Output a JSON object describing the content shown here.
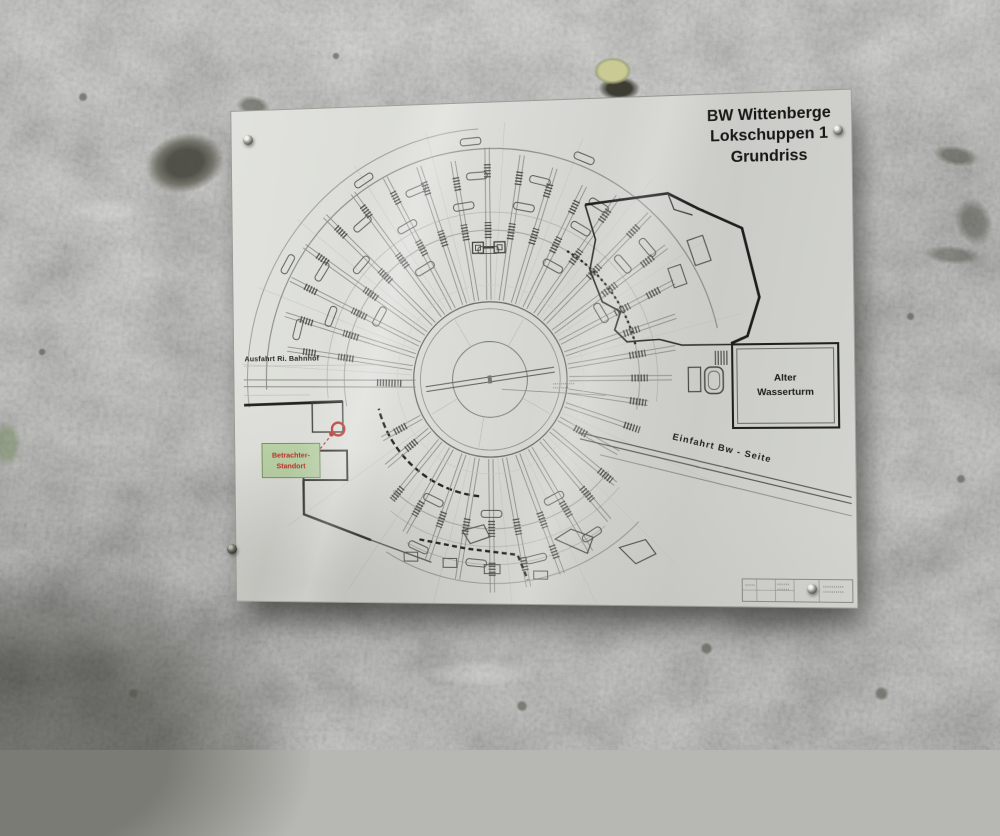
{
  "sign": {
    "title_lines": [
      "BW Wittenberge",
      "Lokschuppen 1",
      "Grundriss"
    ],
    "label_exit": "Ausfahrt Ri. Bahnhof",
    "label_water_tower_lines": [
      "Alter",
      "Wasserturm"
    ],
    "label_entry": "Einfahrt Bw - Seite",
    "viewer_label_lines": [
      "Betrachter-",
      "Standort"
    ],
    "colors": {
      "paper": "#d8d9d4",
      "wall": "#b7b8b3",
      "ink_dark": "#1d1d1b",
      "ink_mid": "#55554f",
      "ink_light": "#9a9a96",
      "marker_red": "#b5342a",
      "viewer_bg": "#b9d2a6",
      "viewer_border": "#75905e",
      "viewer_text": "#c22b20"
    }
  },
  "plan": {
    "center": [
      266,
      278
    ],
    "turntable": {
      "radii": [
        78,
        71,
        38
      ],
      "bridge_angle": -8,
      "spokes": [
        -120,
        -60,
        30,
        100,
        150
      ]
    },
    "colors": {
      "track": "#8d8d8a",
      "hatch": "#4c4c49",
      "guide": "#c0c0bc",
      "loco": "#5a5a57"
    },
    "guides": [
      -176,
      -158,
      -140,
      -122,
      -104,
      -86,
      -68,
      -50,
      -32,
      -14,
      25,
      45,
      65,
      85,
      105,
      125,
      145
    ],
    "tracks": [
      [
        -171,
        212
      ],
      [
        -162,
        222
      ],
      [
        -153,
        230
      ],
      [
        -144,
        235
      ],
      [
        -135,
        238
      ],
      [
        -126,
        236
      ],
      [
        -117,
        231
      ],
      [
        -108,
        227
      ],
      [
        -99,
        223
      ],
      [
        -90,
        233
      ],
      [
        -81,
        227
      ],
      [
        -72,
        221
      ],
      [
        -63,
        215
      ],
      [
        -54,
        223
      ],
      [
        -45,
        229
      ],
      [
        -36,
        220
      ],
      [
        -27,
        208
      ],
      [
        -18,
        196
      ],
      [
        -9,
        188
      ],
      [
        0,
        182
      ],
      [
        9,
        160
      ],
      [
        19,
        150
      ],
      [
        30,
        148
      ],
      [
        40,
        163
      ],
      [
        50,
        184
      ],
      [
        60,
        199
      ],
      [
        70,
        207
      ],
      [
        80,
        211
      ],
      [
        90,
        214
      ],
      [
        100,
        204
      ],
      [
        110,
        193
      ],
      [
        120,
        178
      ],
      [
        130,
        158
      ],
      [
        141,
        138
      ],
      [
        152,
        126
      ]
    ],
    "arcs": [
      [
        150,
        -190,
        12,
        1,
        "",
        "#a2a29e"
      ],
      [
        150,
        38,
        132,
        1,
        "",
        "#a2a29e"
      ],
      [
        168,
        -186,
        8,
        0.8,
        "",
        "#b2b2ae"
      ],
      [
        168,
        40,
        128,
        0.8,
        "",
        "#b5b5b1"
      ],
      [
        232,
        -182,
        -12,
        1.2,
        "",
        "#8e8e8a"
      ],
      [
        252,
        -186,
        -92,
        1,
        "",
        "#9c9c98"
      ],
      [
        205,
        44,
        122,
        1,
        "",
        "#9a9a94"
      ],
      [
        186,
        52,
        118,
        0.8,
        "",
        "#adada9"
      ],
      [
        118,
        96,
        166,
        2.4,
        "6 3.5",
        "#22221f"
      ],
      [
        150,
        -58,
        -12,
        2.2,
        "2.5 3",
        "#22221f"
      ]
    ],
    "locos": [
      [
        205,
        -165
      ],
      [
        205,
        -147
      ],
      [
        205,
        -129
      ],
      [
        205,
        -111
      ],
      [
        205,
        -93
      ],
      [
        205,
        -75
      ],
      [
        205,
        -57
      ],
      [
        205,
        -39
      ],
      [
        176,
        -158
      ],
      [
        176,
        -138
      ],
      [
        176,
        -118
      ],
      [
        176,
        -98
      ],
      [
        176,
        -78
      ],
      [
        176,
        -58
      ],
      [
        176,
        -40
      ],
      [
        240,
        -150
      ],
      [
        240,
        -122
      ],
      [
        240,
        -94
      ],
      [
        240,
        -66
      ],
      [
        130,
        -150
      ],
      [
        130,
        -120
      ],
      [
        130,
        -90
      ],
      [
        130,
        -60
      ],
      [
        130,
        -30
      ],
      [
        185,
        57
      ],
      [
        185,
        76
      ],
      [
        185,
        95
      ],
      [
        185,
        114
      ],
      [
        135,
        62
      ],
      [
        135,
        90
      ],
      [
        135,
        116
      ]
    ],
    "extras": [
      {
        "t": "path",
        "p": "M 364 105 L 446 96 L 476 112 L 518 132 L 534 200 L 522 238 L 506 245",
        "s": "#1d1d1b",
        "w": 2.6
      },
      {
        "t": "path",
        "p": "M 364 105 L 374 140 L 368 170 L 380 202 L 398 212 L 392 230 L 404 242 L 436 240 L 458 246 L 506 246",
        "s": "#2c2c29",
        "w": 1.6
      },
      {
        "t": "path",
        "p": "M 446 96 L 452 112 L 470 118",
        "s": "#3a3a36",
        "w": 1.2
      },
      {
        "t": "line",
        "x1": 10,
        "y1": 276,
        "x2": 190,
        "y2": 278,
        "s": "#8d8d8a",
        "w": 1
      },
      {
        "t": "line",
        "x1": 10,
        "y1": 283,
        "x2": 190,
        "y2": 285,
        "s": "#8d8d8a",
        "w": 1
      },
      {
        "t": "line",
        "x1": 150,
        "y1": 280,
        "x2": 176,
        "y2": 281,
        "s": "#4c4c49",
        "w": 7,
        "d": "1.3 1.7"
      },
      {
        "t": "line",
        "x1": 10,
        "y1": 262,
        "x2": 150,
        "y2": 262,
        "s": "#b0b0ab",
        "w": 0.6
      },
      {
        "t": "line",
        "x1": 10,
        "y1": 292,
        "x2": 80,
        "y2": 292,
        "s": "#b0b0ab",
        "w": 0.6
      },
      {
        "t": "line",
        "x1": 10,
        "y1": 302,
        "x2": 114,
        "y2": 299,
        "s": "#22221f",
        "w": 2.8
      },
      {
        "t": "rect",
        "x": 82,
        "y": 299,
        "wd": 32,
        "ht": 31,
        "s": "#3a3a37",
        "w": 1.4
      },
      {
        "t": "line",
        "x1": 490,
        "y1": 259,
        "x2": 504,
        "y2": 259,
        "s": "#56544f",
        "w": 14,
        "d": "1.2 1.6"
      },
      {
        "t": "rect",
        "x": 464,
        "y": 268,
        "wd": 12,
        "ht": 24,
        "s": "#4a4a47",
        "w": 1.2
      },
      {
        "t": "rect",
        "x": 480,
        "y": 268,
        "wd": 18,
        "ht": 26,
        "rx": 6,
        "s": "#4a4a47",
        "w": 1.4
      },
      {
        "t": "rect",
        "x": 483.5,
        "y": 272,
        "wd": 11,
        "ht": 18,
        "rx": 5,
        "s": "#6b6b68",
        "w": 0.9
      },
      {
        "t": "line",
        "x1": 356,
        "y1": 332,
        "x2": 620,
        "y2": 396,
        "s": "#55554f",
        "w": 1.1
      },
      {
        "t": "line",
        "x1": 356,
        "y1": 338,
        "x2": 620,
        "y2": 402,
        "s": "#55554f",
        "w": 1.1
      },
      {
        "t": "line",
        "x1": 376,
        "y1": 354,
        "x2": 620,
        "y2": 414,
        "s": "#8a8a85",
        "w": 0.9
      },
      {
        "t": "path",
        "p": "M 192 439 L 240 448 L 292 454 L 302 479",
        "s": "#22221f",
        "w": 2.4,
        "d": "5 3.5"
      },
      {
        "t": "path",
        "p": "M 72 379 L 72 414 L 142 440",
        "s": "#22221f",
        "w": 2.4
      },
      {
        "t": "path",
        "p": "M 72 349 L 118 349 L 118 379 L 72 379 Z",
        "s": "#2e2e2b",
        "w": 2
      },
      {
        "t": "line",
        "x1": 142,
        "y1": 440,
        "x2": 204,
        "y2": 462,
        "s": "#55554f",
        "w": 1.2
      },
      {
        "t": "path",
        "p": "M 330 438 L 346 428 L 368 436 L 362 452 Z",
        "s": "#4f4f4c",
        "w": 1.1
      },
      {
        "t": "path",
        "p": "M 394 446 L 420 438 L 430 452 L 410 462 Z",
        "s": "#4f4f4c",
        "w": 1.1
      },
      {
        "t": "path",
        "p": "M 236 430 L 258 424 L 264 436 L 244 443 Z",
        "s": "#4f4f4c",
        "w": 1.1
      },
      {
        "t": "rect",
        "x": 176,
        "y": 452,
        "wd": 14,
        "ht": 9,
        "s": "#55554f",
        "w": 1
      },
      {
        "t": "rect",
        "x": 216,
        "y": 458,
        "wd": 14,
        "ht": 9,
        "s": "#55554f",
        "w": 1
      },
      {
        "t": "rect",
        "x": 258,
        "y": 464,
        "wd": 16,
        "ht": 9,
        "s": "#55554f",
        "w": 1
      },
      {
        "t": "rect",
        "x": 308,
        "y": 470,
        "wd": 14,
        "ht": 8,
        "s": "#55554f",
        "w": 1
      },
      {
        "t": "rect",
        "x": 468,
        "y": 140,
        "wd": 16,
        "ht": 26,
        "s": "#55554f",
        "w": 1.1,
        "tr": "rotate(-18 476 153)"
      },
      {
        "t": "rect",
        "x": 448,
        "y": 168,
        "wd": 13,
        "ht": 20,
        "s": "#55554f",
        "w": 1,
        "tr": "rotate(-18 454 178)"
      },
      {
        "t": "circle",
        "cx": 266,
        "cy": 278,
        "r": 95,
        "s": "#c9c9c5",
        "w": 0.6
      },
      {
        "t": "line",
        "x1": 278,
        "y1": 288,
        "x2": 382,
        "y2": 295,
        "s": "#8d8d88",
        "w": 0.7
      },
      {
        "t": "line",
        "x1": 330,
        "y1": 283,
        "x2": 352,
        "y2": 283,
        "s": "#8d8d88",
        "w": 1.2,
        "d": "1 1"
      },
      {
        "t": "line",
        "x1": 330,
        "y1": 287,
        "x2": 346,
        "y2": 287,
        "s": "#8d8d88",
        "w": 1.2,
        "d": "1 1"
      },
      {
        "t": "rect",
        "x": 250,
        "y": 140,
        "wd": 11,
        "ht": 11,
        "s": "#3f3f3c",
        "w": 1.3
      },
      {
        "t": "rect",
        "x": 272,
        "y": 140,
        "wd": 11,
        "ht": 11,
        "s": "#3f3f3c",
        "w": 1.3
      },
      {
        "t": "rect",
        "x": 253,
        "y": 143,
        "wd": 5,
        "ht": 5,
        "s": "#3f3f3c",
        "w": 0.9
      },
      {
        "t": "rect",
        "x": 275,
        "y": 143,
        "wd": 5,
        "ht": 5,
        "s": "#3f3f3c",
        "w": 0.9
      },
      {
        "t": "line",
        "x1": 261,
        "y1": 145.5,
        "x2": 272,
        "y2": 145.5,
        "s": "#3f3f3c",
        "w": 2
      },
      {
        "t": "rect",
        "x": 514,
        "y": 476,
        "wd": 106,
        "ht": 22,
        "s": "#7a7a74",
        "w": 0.8
      },
      {
        "t": "line",
        "x1": 528,
        "y1": 476,
        "x2": 528,
        "y2": 498,
        "s": "#8c8c86",
        "w": 0.6
      },
      {
        "t": "line",
        "x1": 546,
        "y1": 476,
        "x2": 546,
        "y2": 498,
        "s": "#8c8c86",
        "w": 0.6
      },
      {
        "t": "line",
        "x1": 564,
        "y1": 476,
        "x2": 564,
        "y2": 498,
        "s": "#8c8c86",
        "w": 0.6
      },
      {
        "t": "line",
        "x1": 588,
        "y1": 476,
        "x2": 588,
        "y2": 498,
        "s": "#8c8c86",
        "w": 0.6
      },
      {
        "t": "line",
        "x1": 514,
        "y1": 487,
        "x2": 564,
        "y2": 487,
        "s": "#8c8c86",
        "w": 0.6
      },
      {
        "t": "line",
        "x1": 517,
        "y1": 482,
        "x2": 526,
        "y2": 482,
        "s": "#98988f",
        "w": 1.4,
        "d": "1 1"
      },
      {
        "t": "line",
        "x1": 548,
        "y1": 481,
        "x2": 560,
        "y2": 481,
        "s": "#98988f",
        "w": 1.4,
        "d": "1 1"
      },
      {
        "t": "line",
        "x1": 548,
        "y1": 486,
        "x2": 560,
        "y2": 486,
        "s": "#98988f",
        "w": 1.4,
        "d": "1 1"
      },
      {
        "t": "line",
        "x1": 592,
        "y1": 483,
        "x2": 612,
        "y2": 483,
        "s": "#98988f",
        "w": 1.4,
        "d": "1 1"
      },
      {
        "t": "line",
        "x1": 592,
        "y1": 488,
        "x2": 612,
        "y2": 488,
        "s": "#98988f",
        "w": 1.4,
        "d": "1 1"
      },
      {
        "t": "line",
        "x1": 90,
        "y1": 347,
        "x2": 101,
        "y2": 334,
        "s": "#b5342a",
        "w": 1.2,
        "d": "3 2.5"
      },
      {
        "t": "circle",
        "cx": 109,
        "cy": 327,
        "r": 6.5,
        "s": "#b5342a",
        "w": 2.4
      },
      {
        "t": "circle",
        "cx": 102,
        "cy": 332,
        "r": 2.6,
        "f": "#b5342a"
      }
    ]
  }
}
